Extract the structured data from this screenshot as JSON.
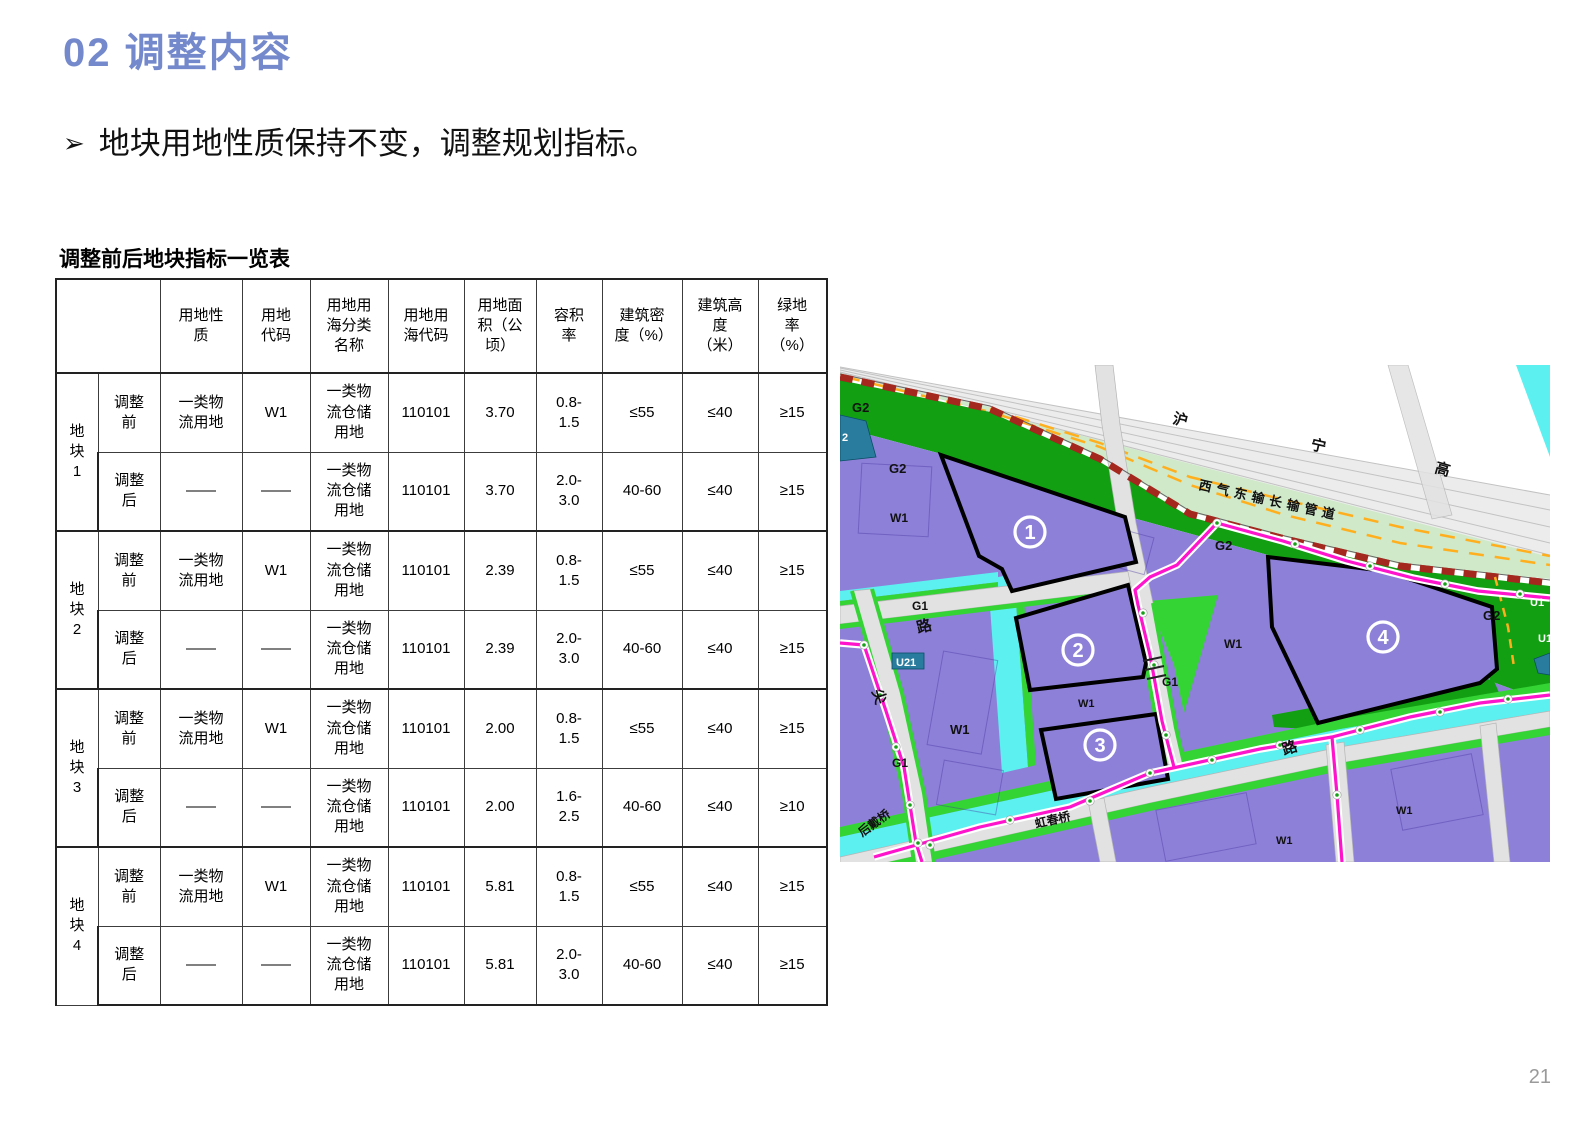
{
  "title": "02 调整内容",
  "bullet": {
    "marker": "➢",
    "text": "地块用地性质保持不变，调整规划指标。"
  },
  "table": {
    "title": "调整前后地块指标一览表",
    "corner": "",
    "headers": [
      "用地性质",
      "用地代码",
      "用地用海分类名称",
      "用地用海代码",
      "用地面积（公顷）",
      "容积率",
      "建筑密度（%）",
      "建筑高度（米）",
      "绿地率（%）"
    ],
    "groups": [
      {
        "label": "地块1",
        "rows": [
          {
            "phase": "调整前",
            "cells": [
              "一类物流用地",
              "W1",
              "一类物流仓储用地",
              "110101",
              "3.70",
              "0.8-1.5",
              "≤55",
              "≤40",
              "≥15"
            ]
          },
          {
            "phase": "调整后",
            "cells": [
              "——",
              "——",
              "一类物流仓储用地",
              "110101",
              "3.70",
              "2.0-3.0",
              "40-60",
              "≤40",
              "≥15"
            ]
          }
        ]
      },
      {
        "label": "地块2",
        "rows": [
          {
            "phase": "调整前",
            "cells": [
              "一类物流用地",
              "W1",
              "一类物流仓储用地",
              "110101",
              "2.39",
              "0.8-1.5",
              "≤55",
              "≤40",
              "≥15"
            ]
          },
          {
            "phase": "调整后",
            "cells": [
              "——",
              "——",
              "一类物流仓储用地",
              "110101",
              "2.39",
              "2.0-3.0",
              "40-60",
              "≤40",
              "≥15"
            ]
          }
        ]
      },
      {
        "label": "地块3",
        "rows": [
          {
            "phase": "调整前",
            "cells": [
              "一类物流用地",
              "W1",
              "一类物流仓储用地",
              "110101",
              "2.00",
              "0.8-1.5",
              "≤55",
              "≤40",
              "≥15"
            ]
          },
          {
            "phase": "调整后",
            "cells": [
              "——",
              "——",
              "一类物流仓储用地",
              "110101",
              "2.00",
              "1.6-2.5",
              "40-60",
              "≤40",
              "≥10"
            ]
          }
        ]
      },
      {
        "label": "地块4",
        "rows": [
          {
            "phase": "调整前",
            "cells": [
              "一类物流用地",
              "W1",
              "一类物流仓储用地",
              "110101",
              "5.81",
              "0.8-1.5",
              "≤55",
              "≤40",
              "≥15"
            ]
          },
          {
            "phase": "调整后",
            "cells": [
              "——",
              "——",
              "一类物流仓储用地",
              "110101",
              "5.81",
              "2.0-3.0",
              "40-60",
              "≤40",
              "≥15"
            ]
          }
        ]
      }
    ]
  },
  "map": {
    "plots": [
      {
        "num": "1",
        "x": 190,
        "y": 167
      },
      {
        "num": "2",
        "x": 238,
        "y": 285
      },
      {
        "num": "3",
        "x": 260,
        "y": 380
      },
      {
        "num": "4",
        "x": 543,
        "y": 272
      }
    ],
    "labels": [
      {
        "text": "G2",
        "x": 12,
        "y": 47,
        "size": 13
      },
      {
        "text": "2",
        "x": 2,
        "y": 76,
        "size": 11,
        "color": "#ffffff"
      },
      {
        "text": "G2",
        "x": 49,
        "y": 108,
        "size": 13
      },
      {
        "text": "W1",
        "x": 50,
        "y": 157,
        "size": 12
      },
      {
        "text": "G1",
        "x": 72,
        "y": 245,
        "size": 12
      },
      {
        "text": "路",
        "x": 78,
        "y": 268,
        "size": 15,
        "rot": -14
      },
      {
        "text": "U21",
        "x": 56,
        "y": 301,
        "size": 11,
        "color": "#ffffff"
      },
      {
        "text": "尖",
        "x": 32,
        "y": 326,
        "size": 15,
        "rot": 72
      },
      {
        "text": "G1",
        "x": 52,
        "y": 402,
        "size": 12
      },
      {
        "text": "W1",
        "x": 110,
        "y": 369,
        "size": 13
      },
      {
        "text": "W1",
        "x": 238,
        "y": 342,
        "size": 11
      },
      {
        "text": "G1",
        "x": 322,
        "y": 321,
        "size": 12
      },
      {
        "text": "G2",
        "x": 375,
        "y": 185,
        "size": 13
      },
      {
        "text": "W1",
        "x": 384,
        "y": 283,
        "size": 12
      },
      {
        "text": "沪",
        "x": 332,
        "y": 58,
        "size": 15,
        "rot": 13
      },
      {
        "text": "宁",
        "x": 470,
        "y": 84,
        "size": 15,
        "rot": 13
      },
      {
        "text": "高",
        "x": 594,
        "y": 107,
        "size": 15,
        "rot": 16
      },
      {
        "text": "西气东输长输管道",
        "x": 358,
        "y": 124,
        "size": 13,
        "rot": 12.5,
        "spacing": 5
      },
      {
        "text": "G2",
        "x": 643,
        "y": 255,
        "size": 13
      },
      {
        "text": "U1",
        "x": 690,
        "y": 241,
        "size": 11,
        "color": "#ffffff"
      },
      {
        "text": "U1",
        "x": 698,
        "y": 277,
        "size": 11,
        "color": "#ffffff"
      },
      {
        "text": "路",
        "x": 444,
        "y": 390,
        "size": 15,
        "rot": -18
      },
      {
        "text": "虹春桥",
        "x": 196,
        "y": 463,
        "size": 12,
        "rot": -13
      },
      {
        "text": "后戴桥",
        "x": 22,
        "y": 472,
        "size": 12,
        "rot": -36
      },
      {
        "text": "W1",
        "x": 436,
        "y": 479,
        "size": 11
      },
      {
        "text": "W1",
        "x": 556,
        "y": 449,
        "size": 11
      }
    ]
  },
  "page_number": "21",
  "colors": {
    "accent": "#7488cc",
    "purple": "#8d80d8",
    "green-dark": "#12a012",
    "green-bright": "#35d435",
    "green-light": "#cfe9c9",
    "cyan": "#5cf0f0",
    "teal": "#2a7c9e",
    "magenta": "#ff14cc",
    "red-dash": "#a5281e",
    "orange": "#ffaf1e",
    "road": "#ececec",
    "road2": "#e2e2e2",
    "text": "#111111",
    "page-num": "#9a9a9a"
  }
}
